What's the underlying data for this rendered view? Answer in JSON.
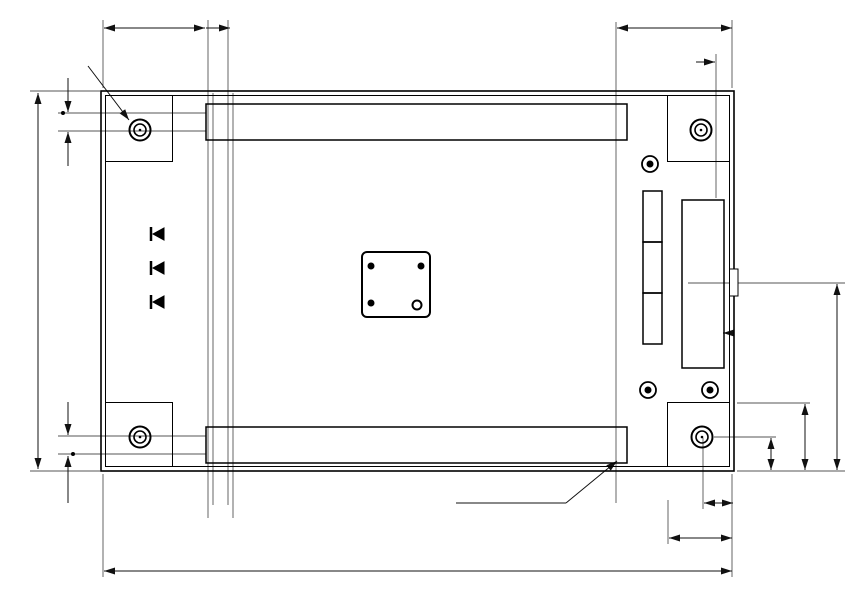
{
  "dims": {
    "top_width_left": "15.24",
    "top_pitch_left": "2.54",
    "top_width_right": "17.78",
    "top_pitch_right": "2.54",
    "hole_note": "4- ø3.6",
    "left_upper_1": "2.54",
    "left_upper_2": "2.54",
    "board_height": "55.88",
    "left_lower_1": "2.54",
    "left_lower_2": "2.54",
    "board_width": "93.98",
    "bottom_offset_1": "5.08",
    "bottom_offset_2": "10",
    "right_offset_1": "5.08",
    "right_offset_2": "10",
    "right_cne_height": "27.94",
    "pin_hole_dia": "ø0.8"
  },
  "cn1": {
    "label": "CN1",
    "left_top": "49",
    "left_bottom": "50",
    "right_top": "1",
    "right_bottom": "2"
  },
  "cn2": {
    "label": "CN2",
    "left_top": "2",
    "left_bottom": "1",
    "right_top": "50",
    "right_bottom": "49"
  },
  "cne": {
    "label": "CNE",
    "top_pins": "14 13",
    "bottom_pin_2": "2",
    "bottom_pin_1": "1"
  },
  "pads": {
    "uvdd": "UVDD",
    "pwr": "PWR",
    "vdd": "VDD",
    "vss": "VSS",
    "vss_pin2": "2",
    "vss_pin1": "1"
  },
  "header": {
    "rows": [
      "USR",
      "C",
      "CNE",
      "USR",
      "J2-P00/TEST0 C",
      "CNE",
      "USR",
      "J1-RESET-N C",
      "CNE"
    ],
    "j2": "J2",
    "j1": "J1"
  },
  "ic": {
    "refdes": "U1",
    "pin26": "26",
    "pin27": "27",
    "pin13": "13",
    "pin39": "39",
    "pin40": "40",
    "pin52": "52"
  },
  "parts": {
    "j12": "J12",
    "j11": "J11",
    "j10": "J10",
    "c8": "C8",
    "c7": "C7",
    "c6": "C6",
    "j9": "J9",
    "j8": "J8",
    "c5": "C5",
    "r4": "R4",
    "c2": "C2",
    "c1": "C1",
    "c4": "C4",
    "c3": "C3",
    "x1": "X1",
    "j7": "J7",
    "j6": "J6"
  },
  "leds": {
    "p20": "P20",
    "p21": "P21",
    "p22": "P22",
    "r1": "R1",
    "j3": "J3",
    "r2": "R2",
    "j4": "J4",
    "r3": "R3",
    "j5": "J5"
  },
  "logo": {
    "group": "ROHM GROUP",
    "brand": "LAPIS",
    "sub": "SEMICONDUCTOR"
  },
  "silk": {
    "part_no": "QTU-11848",
    "board_name": "RB-D62Q1544TB52",
    "bottom_note": "L1 BE6KST"
  },
  "geometry": {
    "vias": [
      [
        268,
        147
      ],
      [
        243,
        164
      ],
      [
        259,
        191
      ],
      [
        311,
        191
      ],
      [
        259,
        232
      ],
      [
        230,
        237
      ],
      [
        203,
        246
      ],
      [
        190,
        232
      ],
      [
        260,
        233
      ],
      [
        345,
        232
      ],
      [
        404,
        202
      ],
      [
        417,
        202
      ],
      [
        429,
        202
      ],
      [
        478,
        199
      ],
      [
        488,
        228
      ],
      [
        488,
        251
      ],
      [
        530,
        147
      ],
      [
        562,
        147
      ],
      [
        583,
        146
      ],
      [
        632,
        147
      ],
      [
        558,
        164
      ],
      [
        583,
        182
      ],
      [
        632,
        182
      ],
      [
        549,
        191
      ],
      [
        557,
        213
      ],
      [
        583,
        231
      ],
      [
        549,
        240
      ],
      [
        574,
        249
      ],
      [
        650,
        113
      ],
      [
        634,
        146
      ],
      [
        633,
        182
      ],
      [
        293,
        283
      ],
      [
        300,
        292
      ],
      [
        303,
        300
      ],
      [
        345,
        332
      ],
      [
        352,
        385
      ],
      [
        395,
        417
      ],
      [
        183,
        444
      ],
      [
        193,
        405
      ],
      [
        123,
        393
      ],
      [
        175,
        350
      ],
      [
        650,
        360
      ],
      [
        659,
        453
      ],
      [
        568,
        386
      ],
      [
        598,
        419
      ],
      [
        397,
        419
      ],
      [
        468,
        280
      ],
      [
        466,
        290
      ],
      [
        466,
        301
      ],
      [
        470,
        317
      ],
      [
        472,
        333
      ],
      [
        528,
        308
      ],
      [
        528,
        342
      ],
      [
        545,
        338
      ],
      [
        198,
        249
      ],
      [
        198,
        265
      ],
      [
        198,
        299
      ],
      [
        198,
        335
      ],
      [
        218,
        320
      ],
      [
        631,
        330
      ],
      [
        718,
        207
      ],
      [
        718,
        359
      ],
      [
        63,
        113
      ],
      [
        73,
        454
      ]
    ],
    "components": [
      {
        "x": 392,
        "y": 177,
        "w": 11,
        "h": 20,
        "kind": "solid"
      },
      {
        "x": 405,
        "y": 177,
        "w": 11,
        "h": 20,
        "kind": "solid"
      },
      {
        "x": 418,
        "y": 177,
        "w": 11,
        "h": 20,
        "kind": "solid"
      },
      {
        "x": 399,
        "y": 207,
        "w": 10,
        "h": 17,
        "kind": "open"
      },
      {
        "x": 412,
        "y": 207,
        "w": 10,
        "h": 17,
        "kind": "open"
      },
      {
        "x": 425,
        "y": 207,
        "w": 10,
        "h": 17,
        "kind": "open"
      },
      {
        "x": 440,
        "y": 216,
        "w": 10,
        "h": 17,
        "kind": "solid"
      },
      {
        "x": 452,
        "y": 216,
        "w": 10,
        "h": 17,
        "kind": "solid"
      },
      {
        "x": 441,
        "y": 241,
        "w": 17,
        "h": 10,
        "kind": "open"
      },
      {
        "x": 453,
        "y": 276,
        "w": 10,
        "h": 13,
        "kind": "open"
      },
      {
        "x": 444,
        "y": 284,
        "w": 16,
        "h": 10,
        "kind": "solid"
      },
      {
        "x": 444,
        "y": 295,
        "w": 16,
        "h": 10,
        "kind": "solid"
      },
      {
        "x": 448,
        "y": 311,
        "w": 21,
        "h": 11,
        "kind": "open"
      },
      {
        "x": 448,
        "y": 327,
        "w": 21,
        "h": 11,
        "kind": "open"
      },
      {
        "x": 482,
        "y": 313,
        "w": 14,
        "h": 25,
        "kind": "solid"
      },
      {
        "x": 506,
        "y": 304,
        "w": 19,
        "h": 11,
        "kind": "solid"
      },
      {
        "x": 506,
        "y": 336,
        "w": 19,
        "h": 11,
        "kind": "solid"
      },
      {
        "x": 175,
        "y": 243,
        "w": 19,
        "h": 12,
        "kind": "solid"
      },
      {
        "x": 175,
        "y": 259,
        "w": 19,
        "h": 12,
        "kind": "solid"
      },
      {
        "x": 175,
        "y": 277,
        "w": 19,
        "h": 12,
        "kind": "solid"
      },
      {
        "x": 175,
        "y": 295,
        "w": 19,
        "h": 12,
        "kind": "solid"
      },
      {
        "x": 175,
        "y": 313,
        "w": 19,
        "h": 12,
        "kind": "solid"
      },
      {
        "x": 175,
        "y": 329,
        "w": 19,
        "h": 12,
        "kind": "solid"
      },
      {
        "x": 148,
        "y": 240,
        "w": 20,
        "h": 18,
        "kind": "led"
      },
      {
        "x": 148,
        "y": 274,
        "w": 20,
        "h": 18,
        "kind": "led"
      },
      {
        "x": 148,
        "y": 308,
        "w": 20,
        "h": 18,
        "kind": "led"
      }
    ],
    "connectors": {
      "cn_cols": 25,
      "cn_x0": 215.5,
      "cn_pitch": 17.05,
      "cn1_rows": [
        113,
        131
      ],
      "cn2_rows": [
        436,
        454
      ],
      "cne_cols": [
        702,
        718
      ],
      "cne_y0": 230,
      "cne_pitch": 17.2,
      "cne_rows": 7,
      "hdr_x": 652.5,
      "hdr_y0": 199,
      "hdr_pitch": 17,
      "hdr_n": 9
    },
    "ic_pins": {
      "top_y": 244,
      "bot_y": 317,
      "x0": 366,
      "xpitch": 5,
      "left_x": 354,
      "right_x": 430,
      "y0": 257,
      "ypitch": 4.6,
      "n": 13
    }
  }
}
